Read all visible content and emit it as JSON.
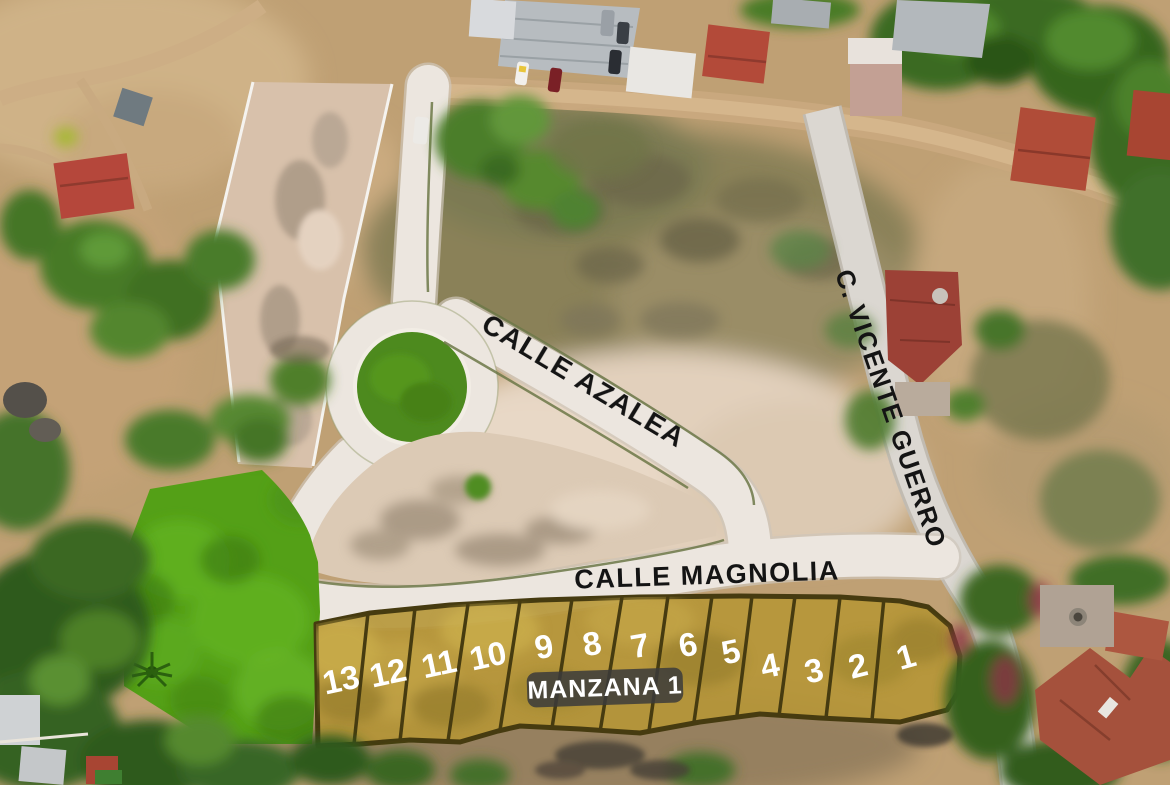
{
  "streets": {
    "azalea": "CALLE AZALEA",
    "magnolia": "CALLE MAGNOLIA",
    "vicente_guerro": "C. VICENTE GUERRO"
  },
  "block": {
    "badge": "MANZANA 1"
  },
  "lots": {
    "numbers": [
      "13",
      "12",
      "11",
      "10",
      "9",
      "8",
      "7",
      "6",
      "5",
      "4",
      "3",
      "2",
      "1"
    ]
  },
  "colors": {
    "lot_fill": "#b69637",
    "lot_border": "#463b10",
    "green_highlight": "#54a017",
    "paved_road": "#ece6df",
    "street_label_text": "#141414",
    "lot_number_text": "#ffffff",
    "badge_bg": "#3b3b3b",
    "badge_text": "#ffffff"
  }
}
